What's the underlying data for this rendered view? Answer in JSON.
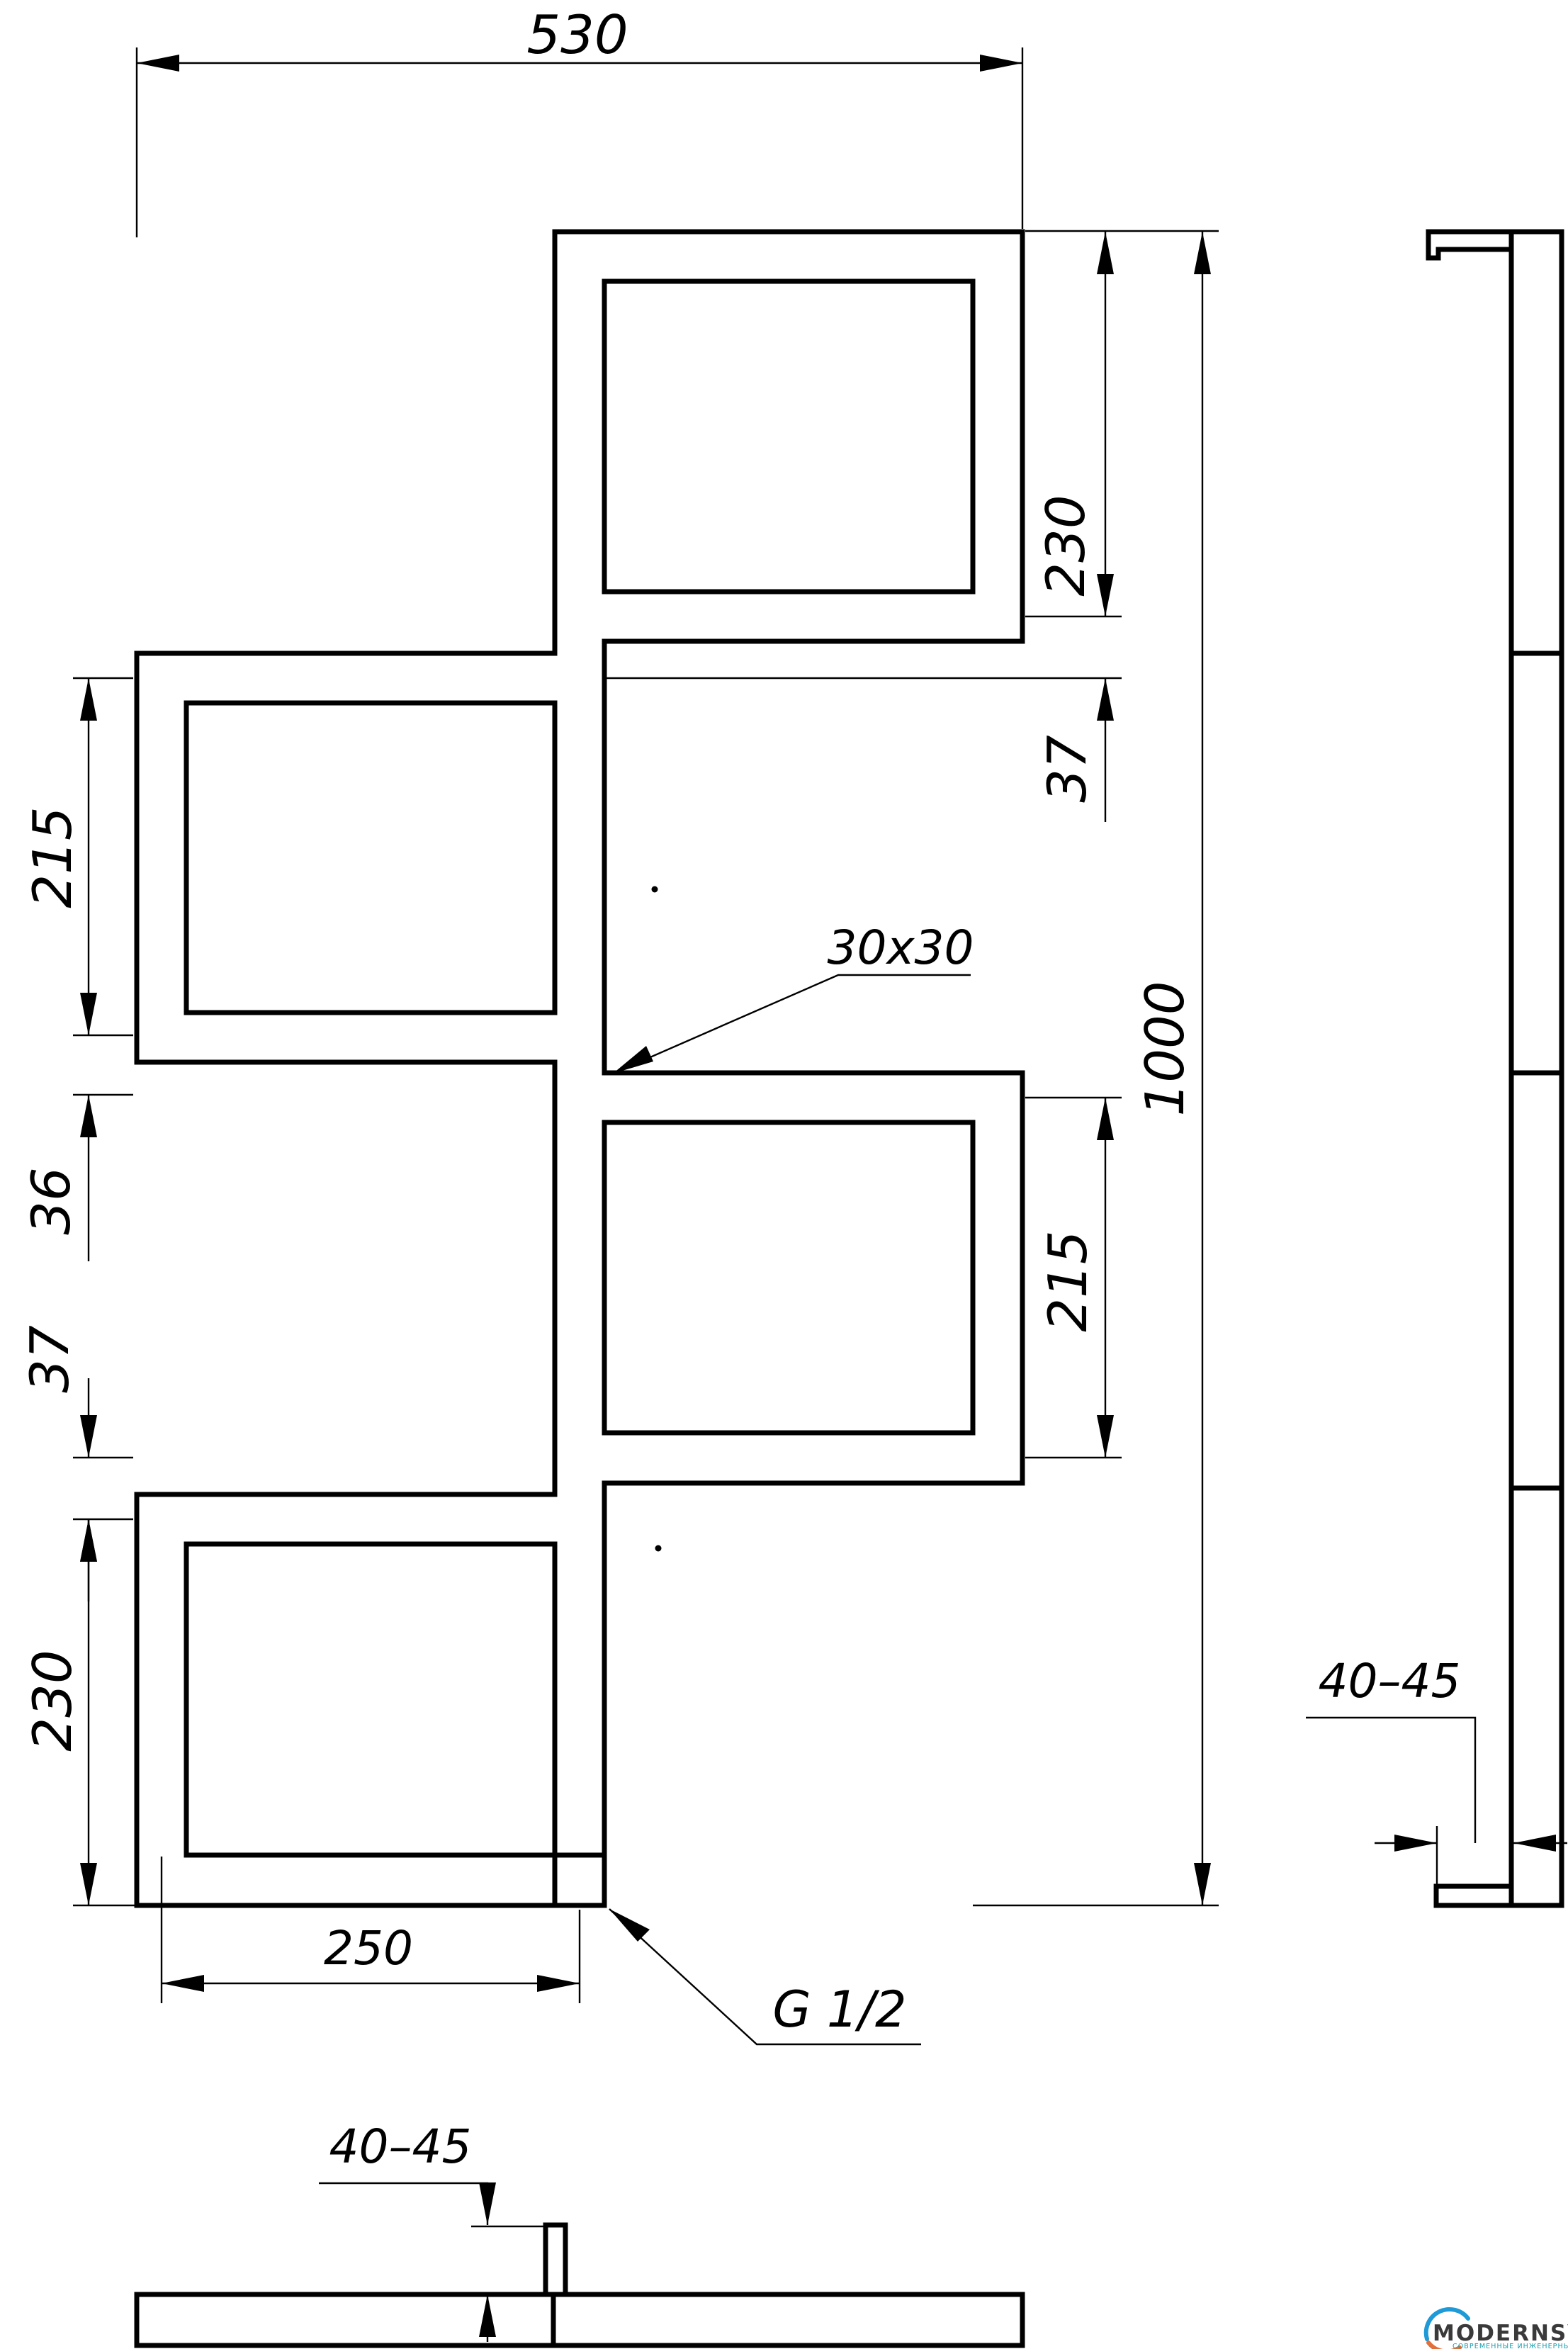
{
  "drawing": {
    "front_view": {
      "top_width": "530",
      "right_dims": {
        "d230": "230",
        "d37": "37",
        "d215": "215",
        "d1000": "1000"
      },
      "left_dims": {
        "d215": "215",
        "d36": "36",
        "d37": "37",
        "d230": "230"
      },
      "bottom_dim": "250",
      "tube_label": "30x30",
      "thread_label": "G 1/2"
    },
    "side_view": {
      "bracket_dim": "40–45"
    },
    "bottom_view": {
      "bracket_dim": "40–45"
    }
  },
  "logo": {
    "brand": "MODERNSYS",
    "tagline": "СОВРЕМЕННЫЕ ИНЖЕНЕРНЫЕ СИСТЕМЫ",
    "colors": {
      "arc_top": "#1f9ad6",
      "arc_bottom": "#e2703a",
      "brand_text": "#3a3a3a",
      "tagline_text": "#149cac"
    }
  }
}
